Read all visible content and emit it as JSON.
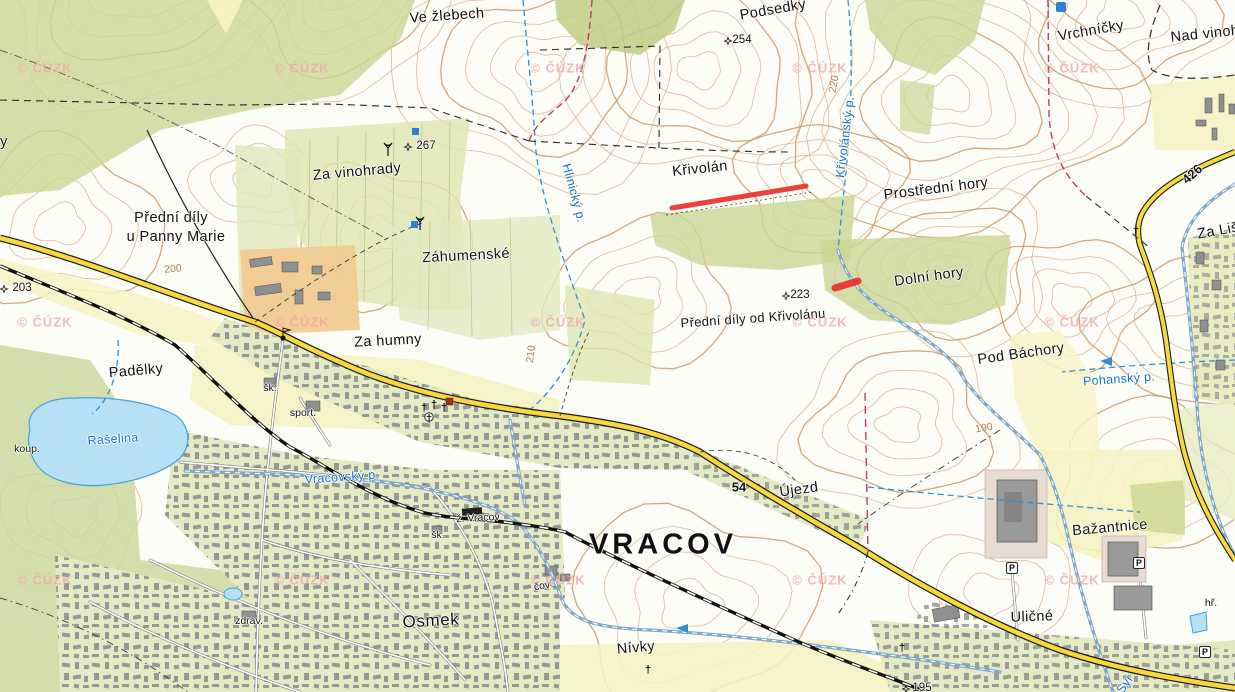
{
  "map": {
    "kind": "czech-topographic-cadastral-map",
    "town": "Vracov",
    "attribution": "© ČÚZK",
    "colors": {
      "highlight": "#ee2f2e",
      "forest": "#cbd693",
      "field_yellow": "#f8f3c3",
      "lake": "#b5e0f5",
      "stream_blue": "#2f8fd0",
      "road_yellow": "#f7d83e",
      "boundary_magenta": "#c23a6a",
      "contour_brown": "#d6a87e",
      "watermark_pink": "#f2a9a9"
    }
  },
  "labels": [
    {
      "text": "Ve žlebech",
      "x": 447,
      "y": 16,
      "rot": -4,
      "cls": "place"
    },
    {
      "text": "Podsedky",
      "x": 773,
      "y": 10,
      "rot": -10,
      "cls": "place"
    },
    {
      "text": "Vrchníčky",
      "x": 1091,
      "y": 31,
      "rot": -10,
      "cls": "place"
    },
    {
      "text": "Nad vinohrad",
      "x": 1216,
      "y": 33,
      "rot": -6,
      "cls": "place"
    },
    {
      "text": "y",
      "x": 4,
      "y": 142,
      "rot": 0,
      "cls": "place"
    },
    {
      "text": "Za vinohrady",
      "x": 357,
      "y": 172,
      "rot": -5,
      "cls": "place"
    },
    {
      "text": "Křivolán",
      "x": 700,
      "y": 169,
      "rot": -6,
      "cls": "place"
    },
    {
      "text": "Prostřední hory",
      "x": 936,
      "y": 189,
      "rot": -7,
      "cls": "place"
    },
    {
      "text": "Přední díly",
      "x": 171,
      "y": 218,
      "rot": 0,
      "cls": "place"
    },
    {
      "text": "u Panny Marie",
      "x": 176,
      "y": 237,
      "rot": 0,
      "cls": "place"
    },
    {
      "text": "Záhumenské",
      "x": 466,
      "y": 256,
      "rot": -3,
      "cls": "place"
    },
    {
      "text": "Dolní hory",
      "x": 929,
      "y": 277,
      "rot": -8,
      "cls": "place"
    },
    {
      "text": "Přední díly od Křivolánu",
      "x": 753,
      "y": 318,
      "rot": -4,
      "cls": "place-sm"
    },
    {
      "text": "Pod Báchory",
      "x": 1021,
      "y": 354,
      "rot": -8,
      "cls": "place"
    },
    {
      "text": "Za humny",
      "x": 388,
      "y": 341,
      "rot": -3,
      "cls": "place"
    },
    {
      "text": "Padělky",
      "x": 136,
      "y": 371,
      "rot": -5,
      "cls": "place"
    },
    {
      "text": "Újezd",
      "x": 799,
      "y": 490,
      "rot": -8,
      "cls": "place"
    },
    {
      "text": "Osmek",
      "x": 431,
      "y": 621,
      "rot": -3,
      "cls": "settlement"
    },
    {
      "text": "Nívky",
      "x": 636,
      "y": 648,
      "rot": -5,
      "cls": "place"
    },
    {
      "text": "Bažantnice",
      "x": 1110,
      "y": 528,
      "rot": -5,
      "cls": "place"
    },
    {
      "text": "Uličné",
      "x": 1032,
      "y": 617,
      "rot": -2,
      "cls": "place"
    },
    {
      "text": "Za Liščí",
      "x": 1224,
      "y": 230,
      "rot": -10,
      "cls": "place"
    },
    {
      "text": "VRACOV",
      "x": 663,
      "y": 545,
      "rot": 0,
      "cls": "city"
    },
    {
      "text": "Hlinický p.",
      "x": 574,
      "y": 193,
      "rot": 75,
      "cls": "stream"
    },
    {
      "text": "Křivolánský p.",
      "x": 845,
      "y": 137,
      "rot": -83,
      "cls": "stream"
    },
    {
      "text": "Pohanský p.",
      "x": 1119,
      "y": 379,
      "rot": -4,
      "cls": "stream"
    },
    {
      "text": "Vracovský p.",
      "x": 342,
      "y": 477,
      "rot": -4,
      "cls": "stream"
    },
    {
      "text": "Rašelina",
      "x": 113,
      "y": 439,
      "rot": -4,
      "cls": "stream"
    },
    {
      "text": "Syr",
      "x": 1125,
      "y": 684,
      "rot": -55,
      "cls": "stream"
    },
    {
      "text": "200",
      "x": 173,
      "y": 269,
      "rot": -5,
      "cls": "contour"
    },
    {
      "text": "210",
      "x": 531,
      "y": 354,
      "rot": -83,
      "cls": "contour"
    },
    {
      "text": "220",
      "x": 834,
      "y": 84,
      "rot": -80,
      "cls": "contour"
    },
    {
      "text": "190",
      "x": 984,
      "y": 428,
      "rot": -10,
      "cls": "contour"
    },
    {
      "text": "koup.",
      "x": 27,
      "y": 449,
      "rot": 0,
      "cls": "small"
    },
    {
      "text": "sport.",
      "x": 303,
      "y": 413,
      "rot": 0,
      "cls": "small"
    },
    {
      "text": "šk.",
      "x": 270,
      "y": 388,
      "rot": 0,
      "cls": "small"
    },
    {
      "text": "šk.",
      "x": 438,
      "y": 535,
      "rot": 0,
      "cls": "small"
    },
    {
      "text": "ž. Vracov",
      "x": 478,
      "y": 518,
      "rot": -3,
      "cls": "small"
    },
    {
      "text": "čov",
      "x": 542,
      "y": 586,
      "rot": -10,
      "cls": "small"
    },
    {
      "text": "zdrav.",
      "x": 249,
      "y": 621,
      "rot": 0,
      "cls": "small"
    },
    {
      "text": "hř.",
      "x": 1211,
      "y": 603,
      "rot": 0,
      "cls": "small"
    },
    {
      "text": "426",
      "x": 1192,
      "y": 174,
      "rot": -42,
      "cls": "roadnum"
    },
    {
      "text": "54",
      "x": 739,
      "y": 487,
      "rot": 0,
      "cls": "roadnum"
    }
  ],
  "spot_heights": [
    {
      "value": "254",
      "tx": 742,
      "ty": 40,
      "mx": 728,
      "my": 41
    },
    {
      "value": "267",
      "tx": 426,
      "ty": 146,
      "mx": 408,
      "my": 147
    },
    {
      "value": "223",
      "tx": 800,
      "ty": 295,
      "mx": 786,
      "my": 296
    },
    {
      "value": "203",
      "tx": 22,
      "ty": 288,
      "mx": 4,
      "my": 289
    },
    {
      "value": "195",
      "tx": 922,
      "ty": 688,
      "mx": 906,
      "my": 689
    }
  ],
  "watermark": {
    "text": "© ČÚZK",
    "positions": [
      [
        45,
        68
      ],
      [
        302,
        68
      ],
      [
        558,
        68
      ],
      [
        820,
        68
      ],
      [
        1072,
        68
      ],
      [
        45,
        322
      ],
      [
        302,
        322
      ],
      [
        558,
        322
      ],
      [
        820,
        322
      ],
      [
        1072,
        322
      ],
      [
        45,
        580
      ],
      [
        302,
        580
      ],
      [
        558,
        580
      ],
      [
        820,
        580
      ],
      [
        1072,
        580
      ]
    ]
  },
  "symbols": {
    "parking": {
      "glyph": "P",
      "positions": [
        [
          1012,
          568
        ],
        [
          1139,
          563
        ],
        [
          1205,
          652
        ]
      ]
    },
    "crosses": {
      "glyph": "†",
      "positions": [
        [
          424,
          408
        ],
        [
          434,
          405
        ],
        [
          444,
          408
        ],
        [
          429,
          419
        ],
        [
          648,
          670
        ],
        [
          1136,
          231
        ],
        [
          902,
          648
        ]
      ]
    }
  },
  "highlight": {
    "color": "#ee2f2e",
    "segments": [
      {
        "x1": 672,
        "y1": 208,
        "x2": 806,
        "y2": 186,
        "w": 5
      },
      {
        "x1": 835,
        "y1": 288,
        "x2": 858,
        "y2": 281,
        "w": 7
      }
    ]
  }
}
